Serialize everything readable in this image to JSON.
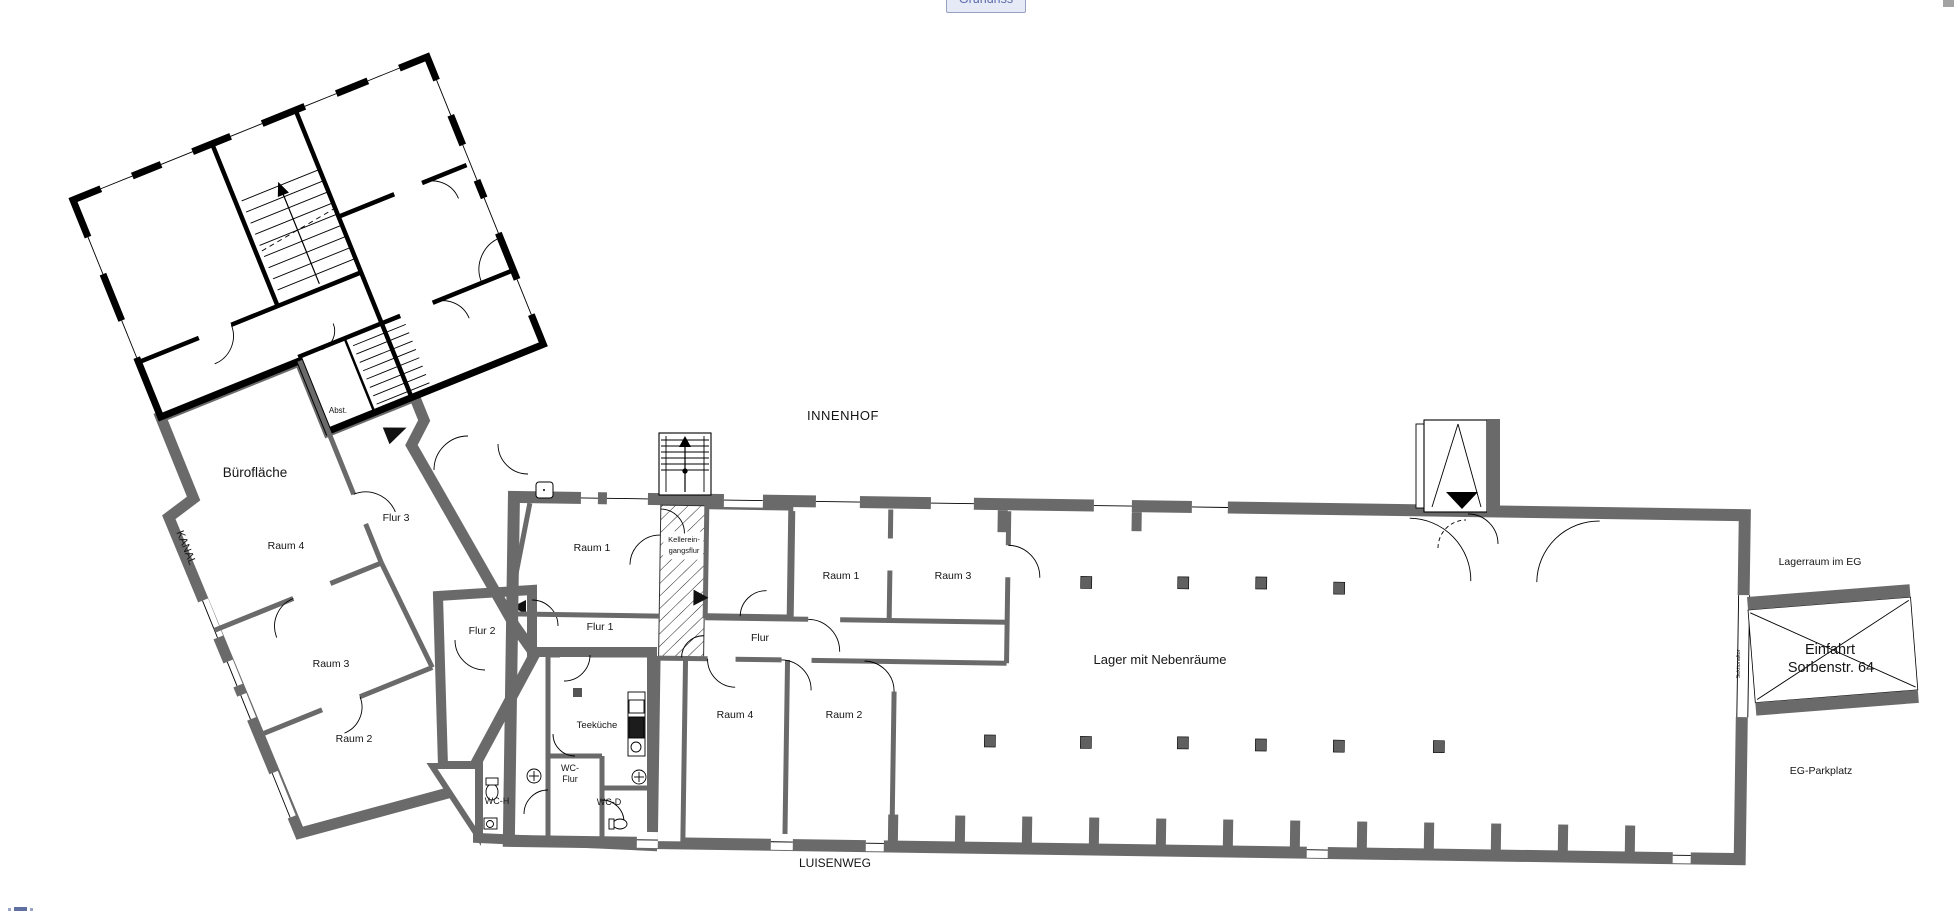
{
  "toolbar": {
    "view_button_label": "Grundriss"
  },
  "colors": {
    "room_fill": "#d8d8d8",
    "wall": "#6a6a6a",
    "masonry": "#000000",
    "button_bg": "#e6eaf7",
    "button_border": "#97a1c2",
    "button_text": "#5b6ba9"
  },
  "plan": {
    "surroundings": {
      "innenhof": "INNENHOF",
      "luisenweg": "LUISENWEG",
      "kanal": "KANAL",
      "lagerraum_im_eg": "Lagerraum im EG",
      "eg_parkplatz": "EG-Parkplatz"
    },
    "office": {
      "buroflaeche": "Bürofläche",
      "raum4": "Raum 4",
      "raum3": "Raum 3",
      "raum2": "Raum 2",
      "flur3": "Flur 3",
      "flur2": "Flur 2",
      "abst": "Abst."
    },
    "service": {
      "flur1": "Flur 1",
      "teekueche": "Teeküche",
      "wc_flur_line1": "WC-",
      "wc_flur_line2": "Flur",
      "wc_h": "WC-H",
      "wc_d": "WC-D"
    },
    "warehouse": {
      "raum1_west": "Raum 1",
      "keller_line1": "Kellerein-",
      "keller_line2": "gangsflur",
      "raum1_east": "Raum 1",
      "raum3": "Raum 3",
      "flur": "Flur",
      "raum4": "Raum 4",
      "raum2": "Raum 2",
      "lager": "Lager mit Nebenräume"
    },
    "entrance": {
      "einfahrt_line1": "Einfahrt",
      "einfahrt_line2": "Sorbenstr. 64",
      "sektionaltor": "Sektionaltor"
    }
  }
}
